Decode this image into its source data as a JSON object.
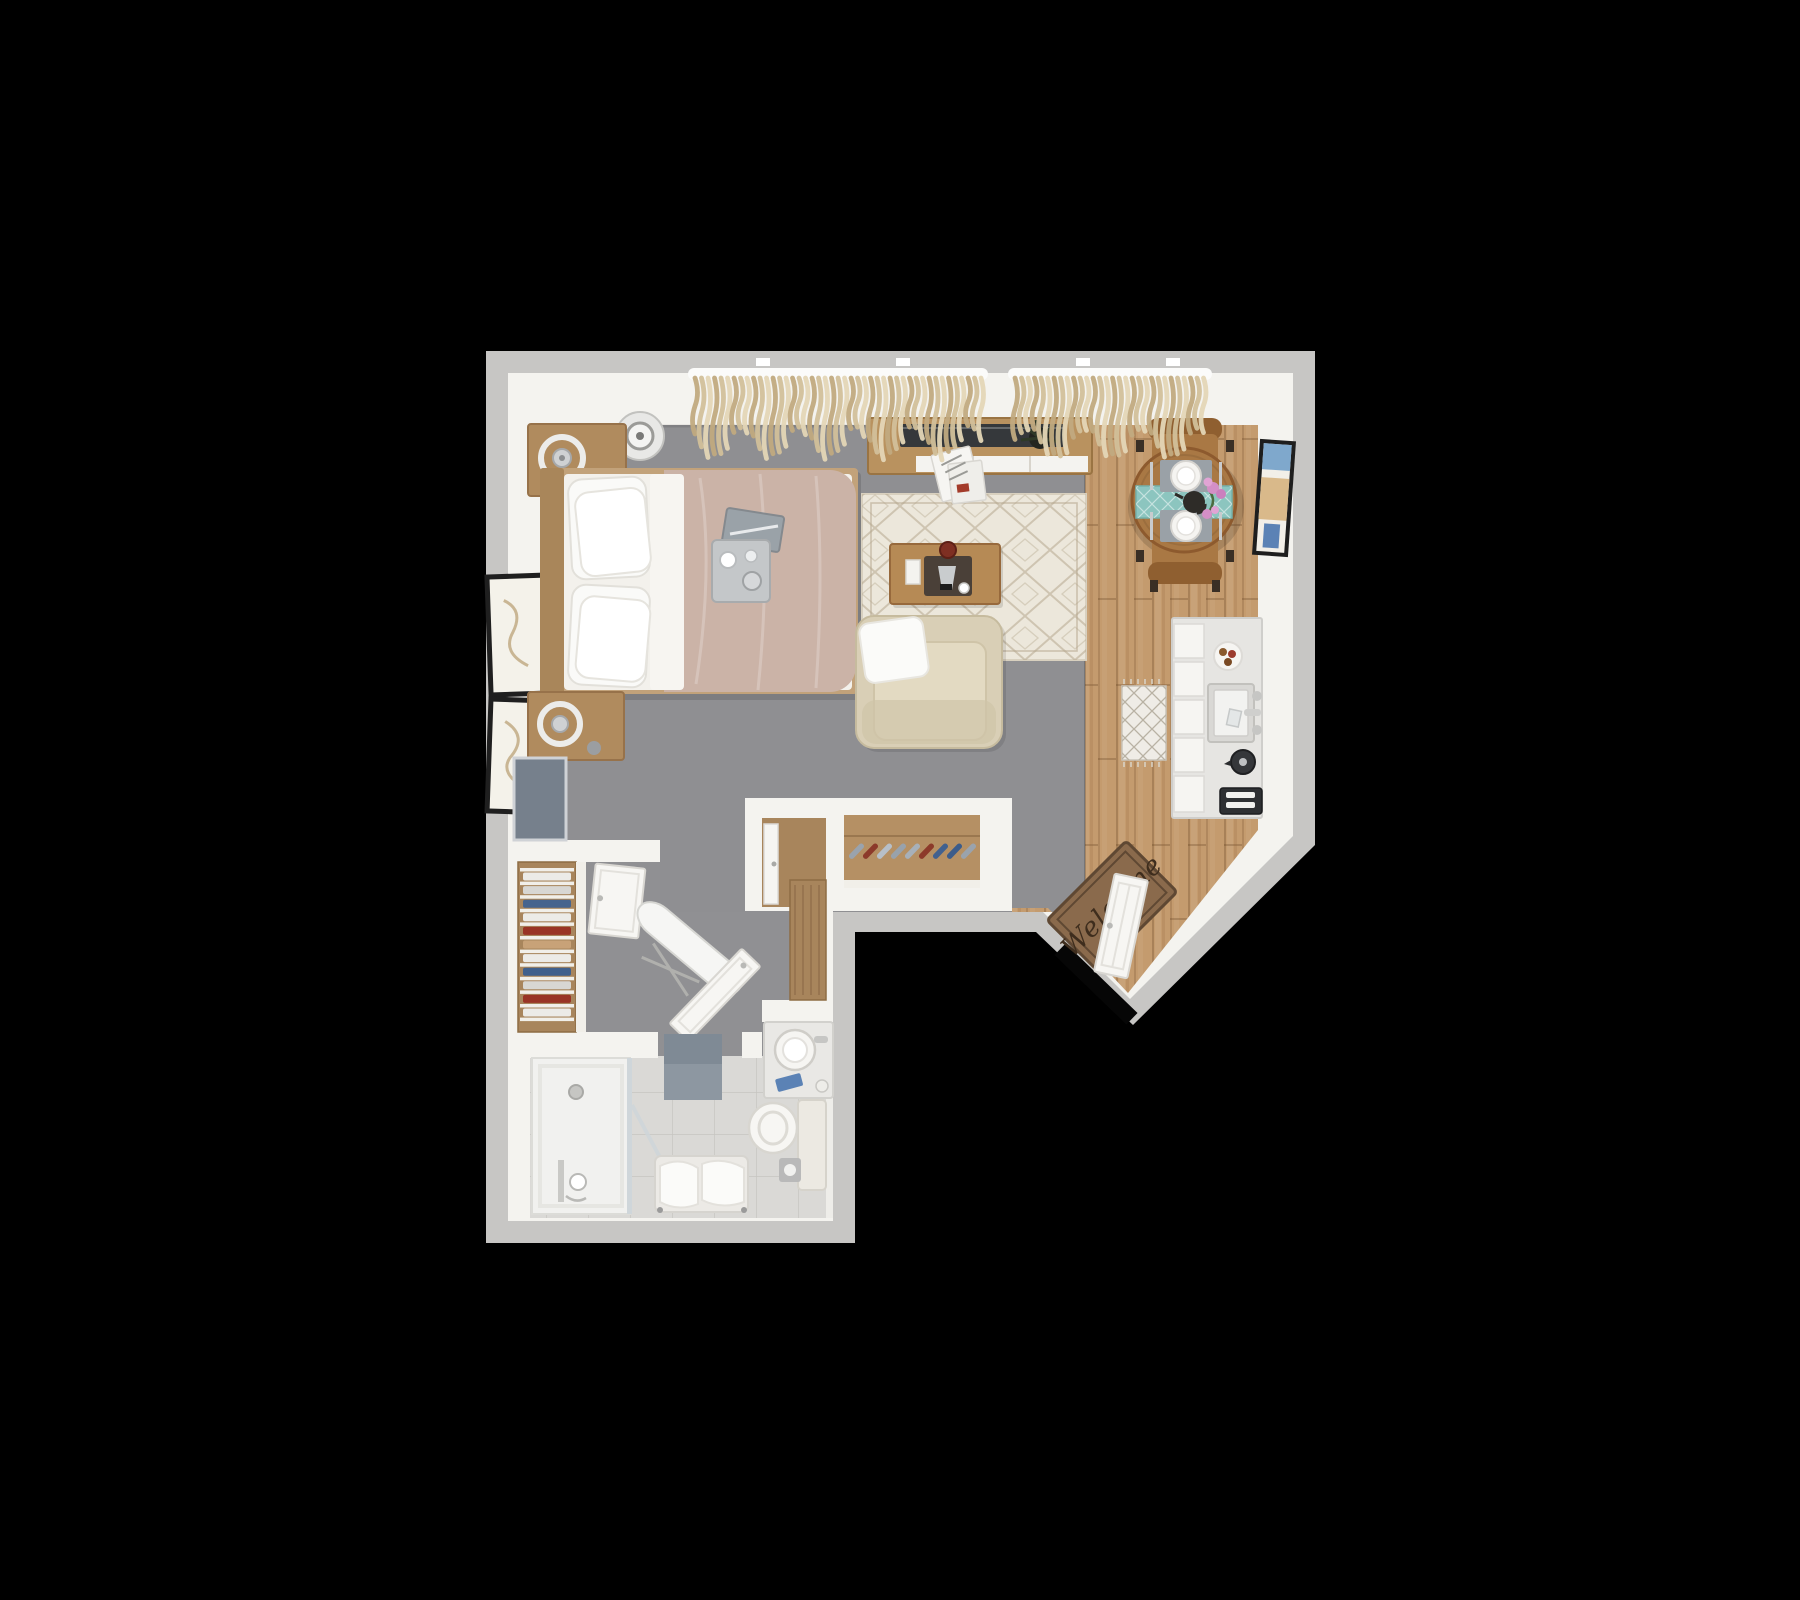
{
  "scene": {
    "welcome_mat_text": "Welcome"
  },
  "palette": {
    "background": "#000000",
    "wall_outer": "#c7c6c4",
    "wall_inner": "#f4f3ef",
    "carpet": "#8f8f92",
    "wood_base": "#c49b6e",
    "tile_base": "#dad9d6",
    "rug_base": "#ece7db",
    "rug_pattern": "#b5a78e",
    "duvet": "#cbb3a7",
    "sheet": "#f3f1ec",
    "pillow": "#fafaf8",
    "headboard": "#a9865a",
    "nightstand": "#b08b5e",
    "console": "#b9925f",
    "tv": "#35383b",
    "coffee_table": "#b68a55",
    "armchair": "#d9cfb6",
    "dining_table": "#a97844",
    "chair_wood": "#8f5f30",
    "runner_teal": "#8cc5bf",
    "placemat": "#9aa1a7",
    "kitchen_counter": "#e6e5e2",
    "appliance_dark": "#2e3033",
    "mat_brown": "#8a6a4c",
    "mat_border": "#5f4833",
    "mat_text": "#3e2d1d",
    "curtain_light": "#e4d6b6",
    "curtain_mid": "#d2c09a",
    "curtain_dark": "#c1aa80",
    "shower": "#f1f1ef",
    "bath_mat": "#8d97a1",
    "glass": "#cfd6da",
    "mirror_panel": "#76808c",
    "closet_wood": "#a8855c",
    "shoe_rack_wood": "#b59064",
    "flower_pink": "#d48fc7",
    "art_blue": "#7fa8cc",
    "art_tan": "#d9b98a",
    "art_blue2": "#5b82b5"
  },
  "shoe_rack": {
    "shoe_colors": [
      "#9aa3ad",
      "#8c3a2a",
      "#b7bfc8",
      "#98a2ac",
      "#a7b0b9",
      "#8c3a2a",
      "#41618f",
      "#3c5c8a",
      "#9aa3ad"
    ]
  },
  "linen_closet": {
    "clothes_colors": [
      "#ecebe7",
      "#d8d7d3",
      "#46648e",
      "#ecebe7",
      "#993425",
      "#c8a278",
      "#ecebe7",
      "#40608c",
      "#d8d7d3",
      "#993425",
      "#ecebe7"
    ]
  },
  "curtains": {
    "spans": [
      {
        "x1": 692,
        "x2": 985
      },
      {
        "x1": 1012,
        "x2": 1208
      }
    ]
  }
}
